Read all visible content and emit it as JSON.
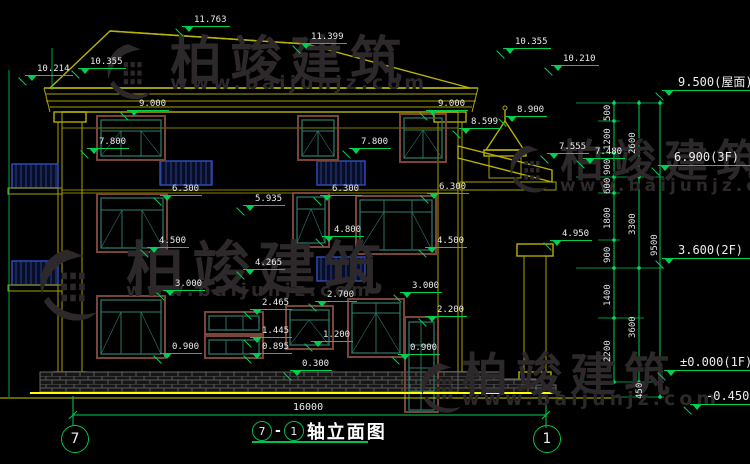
{
  "colors": {
    "background": "#000000",
    "dimension_green": "#00d050",
    "outline_yellow": "#a8a200",
    "ground_yellow": "#ffff00",
    "window_frame_brown": "#7a4536",
    "window_sash_teal": "#2f7d6d",
    "railing_blue": "#2e4fc0",
    "watermark_gray": "#2d282a",
    "text": "#ececec"
  },
  "watermark": {
    "brand": "柏竣建筑",
    "url": "www.baijunjz.com"
  },
  "flags": [
    "11.763",
    "11.399",
    "10.355",
    "10.214",
    "10.355",
    "10.210",
    "9.000",
    "9.000",
    "8.900",
    "8.599",
    "7.800",
    "7.800",
    "7.555",
    "7.480",
    "6.300",
    "6.300",
    "6.300",
    "5.935",
    "4.800",
    "4.950",
    "4.500",
    "4.500",
    "4.265",
    "3.000",
    "3.000",
    "2.700",
    "2.465",
    "2.200",
    "1.445",
    "1.200",
    "0.895",
    "0.900",
    "0.900",
    "0.300",
    "9.500(屋面)",
    "6.900(3F)",
    "3.600(2F)",
    "±0.000(1F)",
    "-0.450"
  ],
  "chain": [
    "500",
    "1200",
    "900",
    "600",
    "1800",
    "900",
    "1400",
    "2200",
    "2600",
    "3300",
    "3600",
    "9500",
    "450"
  ],
  "dims": {
    "total_width": "16000"
  },
  "title": {
    "left_axis": "7",
    "dash": "-",
    "right_axis": "1",
    "name": "轴立面图"
  },
  "axis_bubbles": {
    "left": "7",
    "right": "1"
  }
}
